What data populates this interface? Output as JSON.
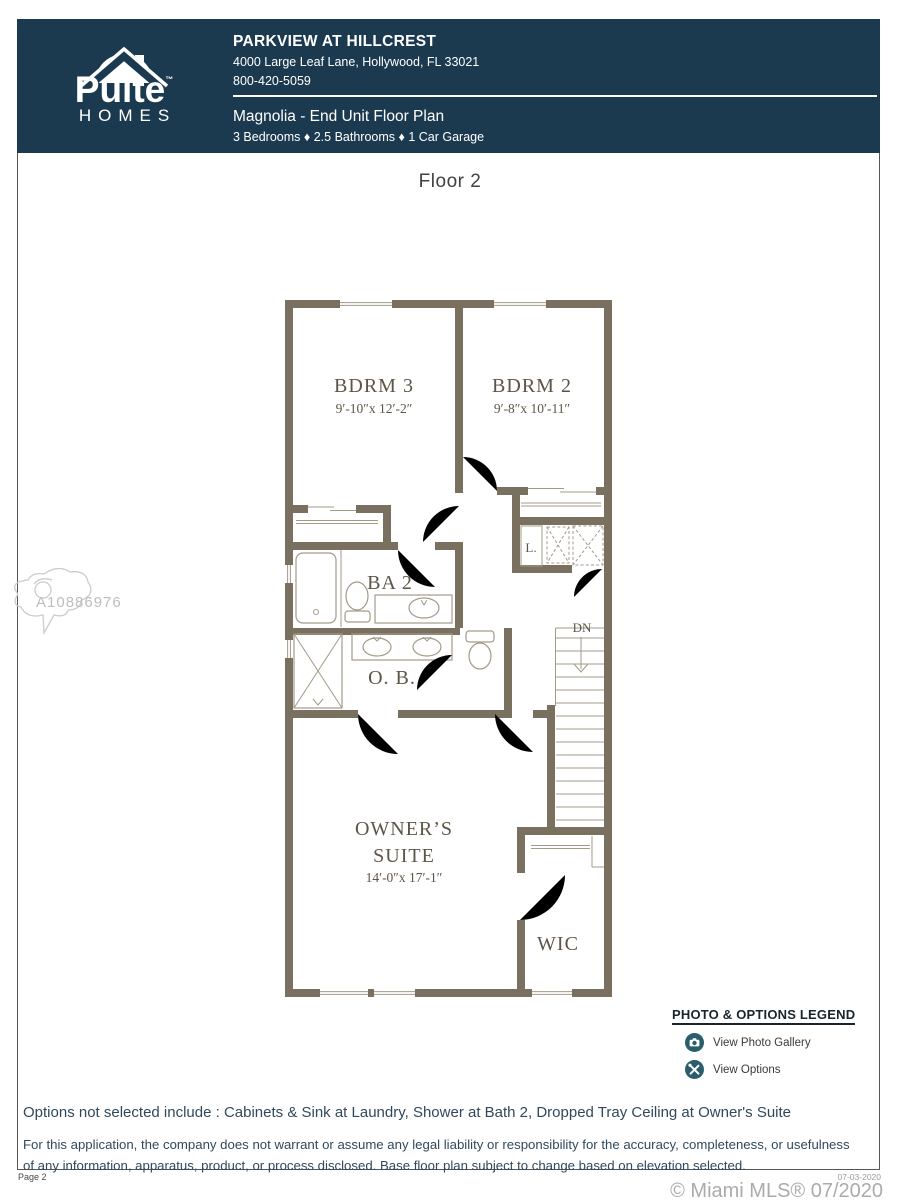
{
  "header": {
    "logo": {
      "brand_top": "Pulte",
      "brand_bottom": "HOMES",
      "tm": "™"
    },
    "community_name": "PARKVIEW AT HILLCREST",
    "address": "4000 Large Leaf Lane, Hollywood, FL 33021",
    "phone": "800-420-5059",
    "plan_name": "Magnolia - End Unit Floor Plan",
    "specs": "3 Bedrooms ♦ 2.5 Bathrooms ♦ 1 Car Garage"
  },
  "floor_title": "Floor 2",
  "floorplan": {
    "rooms": {
      "bdrm3": {
        "name": "BDRM 3",
        "dims": "9′-10″x 12′-2″"
      },
      "bdrm2": {
        "name": "BDRM 2",
        "dims": "9′-8″x 10′-11″"
      },
      "bath2": {
        "name": "BA 2"
      },
      "owners_bath": {
        "name": "O. B."
      },
      "linen": {
        "name": "L."
      },
      "stairs": {
        "name": "DN"
      },
      "owners_suite": {
        "name_line1": "OWNER’S",
        "name_line2": "SUITE",
        "dims": "14′-0″x 17′-1″"
      },
      "wic": {
        "name": "WIC"
      }
    }
  },
  "watermark": {
    "id": "A10886976"
  },
  "legend": {
    "title": "PHOTO & OPTIONS LEGEND",
    "items": [
      {
        "icon": "camera-icon",
        "label": "View Photo Gallery"
      },
      {
        "icon": "tools-icon",
        "label": "View Options"
      }
    ]
  },
  "options_note": "Options not selected include : Cabinets & Sink at Laundry, Shower at Bath 2, Dropped Tray Ceiling at Owner's Suite",
  "disclaimer": "For this application, the company does not warrant or assume any legal liability or responsibility for the accuracy, completeness, or usefulness of any information, apparatus, product, or process disclosed. Base floor plan subject to change based on elevation selected.",
  "footer": {
    "page_label": "Page 2",
    "date": "07-03-2020",
    "credit": "© Miami MLS® 07/2020"
  },
  "colors": {
    "header_bg": "#1b3a50",
    "wall": "#7a7060",
    "legend_icon": "#2b5e6c",
    "body_text": "#31485c"
  }
}
